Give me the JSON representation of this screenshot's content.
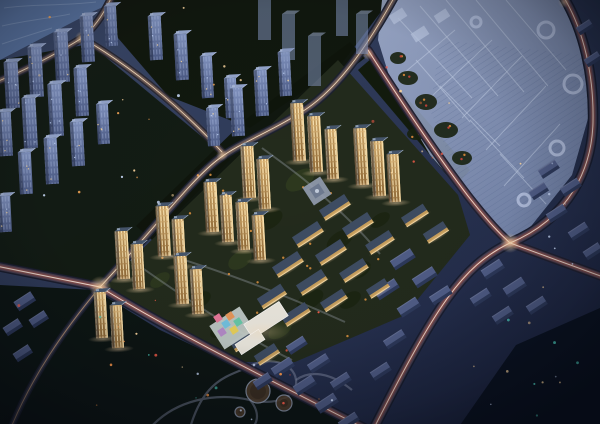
{
  "image": {
    "type": "night-aerial-architectural-rendering",
    "width": 600,
    "height": 424,
    "alt": "Aerial night rendering of a golden-lit residential development amid a dark blue city with glowing road light trails, a ghosted master-plan complex at top right, water at top left and a dark park at bottom left"
  },
  "palette": {
    "bg_top": "#3c4a6a",
    "bg_bottom": "#1b2340",
    "water": "#5d78a6",
    "water_wave": "#8fa6c8",
    "veg_dark": "#101609",
    "veg_park": "#0c1410",
    "veg_corner": "#0a1120",
    "site_ground": "#232b1c",
    "site_shrub": "#d89040",
    "pale_face_hi": "#8395c2",
    "pale_face_lo": "#4c5b86",
    "pale_roof": "#94a5cc",
    "gold_face_hi": "#e3bc7c",
    "gold_face_lo": "#936c38",
    "gold_roof": "#46566c",
    "gold_edge": "#ffe6b0",
    "slab_bg_roof": "#515e88",
    "slab_bg_face": "#2e3a5c",
    "slab_lit_roof": "#3f4d63",
    "slab_lit_face": "#c9a05c",
    "slab_lit_line": "#ffe2a8",
    "road_base": "#151d30",
    "road_major": "#2e3954",
    "road_minor": "#293349",
    "trail_hot_core": "#ffd9bc",
    "trail_hot_mid": "#ff7a52",
    "trail_hot_glow": "#a23c34",
    "trail_warm_core": "#fff0d4",
    "trail_warm_mid": "#ffb26a",
    "trail_warm_glow": "#b06030",
    "ghost_hi": "#b2c0e0",
    "ghost_lo": "#7e90b8",
    "ghost_line": "#ccd7ee",
    "ghost_ring": "#bcc9e6",
    "kindergarten_white": "#ece8de"
  },
  "scene": {
    "water": {
      "poly": "0,0 118,0 92,12 48,35 0,60",
      "waves": [
        "M4,8 C30,4 60,6 96,2",
        "M2,26 C28,20 52,18 70,14",
        "M2,44 C20,38 36,33 52,28"
      ]
    },
    "veg": [
      {
        "poly": "110,0 390,0 340,66 250,128 168,96 118,38",
        "c": "#101609"
      },
      {
        "poly": "0,60 90,44 230,160 100,288 0,270",
        "c": "#121a10"
      },
      {
        "poly": "350,42 365,58 258,140 152,240 136,226 245,120",
        "c": "#0f150c"
      },
      {
        "poly": "0,285 95,290 160,330 240,368 330,410 362,428 0,428",
        "c": "#0c1410"
      },
      {
        "poly": "372,58 470,170 456,186 358,70",
        "c": "#111909"
      },
      {
        "poly": "368,252 416,262 398,312 356,302",
        "c": "#10180d"
      },
      {
        "poly": "516,345 600,308 600,428 458,428",
        "c": "#0a1120"
      }
    ],
    "site": {
      "poly": "338,60 458,195 470,235 405,315 295,362 228,362 100,290 255,140",
      "fill": "#232b1c",
      "mottle": [
        [
          300,
          180,
          16,
          9
        ],
        [
          270,
          220,
          14,
          8
        ],
        [
          340,
          240,
          15,
          8
        ],
        [
          240,
          260,
          13,
          8
        ],
        [
          310,
          300,
          15,
          8
        ],
        [
          200,
          300,
          12,
          7
        ],
        [
          280,
          330,
          13,
          7
        ],
        [
          360,
          270,
          12,
          7
        ],
        [
          380,
          220,
          11,
          6
        ],
        [
          160,
          280,
          11,
          6
        ],
        [
          220,
          330,
          11,
          6
        ],
        [
          350,
          300,
          12,
          7
        ]
      ],
      "paths": [
        "M262,148 C295,172 308,182 317,191 C342,212 362,232 380,254",
        "M158,252 C220,270 285,295 345,322",
        "M120,252 C175,292 235,332 292,360"
      ]
    },
    "ghost": {
      "poly": "382,0 563,0 584,55 589,115 572,175 528,230 506,240 480,212 430,155 395,95 378,40",
      "hatch": "440,40 584,55 589,115 572,175 528,230 506,240 455,170 430,110",
      "lines": [
        "M398,18 L472,98",
        "M420,6 L498,96",
        "M446,0 L524,92",
        "M476,0 L548,86",
        "M506,0 L566,70",
        "M416,60 L470,122",
        "M440,86 L500,146",
        "M470,120 L524,178",
        "M500,154 L546,204",
        "M455,30 L398,78",
        "M492,40 L432,96",
        "M522,56 L462,118",
        "M546,86 L486,150",
        "M560,124 L504,186"
      ],
      "rings": [
        [
          546,
          30,
          8
        ],
        [
          573,
          84,
          9
        ],
        [
          557,
          148,
          7
        ],
        [
          476,
          22,
          5
        ],
        [
          524,
          200,
          6
        ]
      ],
      "veg": [
        [
          408,
          78,
          10,
          7
        ],
        [
          426,
          102,
          11,
          8
        ],
        [
          446,
          130,
          12,
          8
        ],
        [
          416,
          134,
          9,
          6
        ],
        [
          462,
          158,
          10,
          7
        ],
        [
          398,
          58,
          8,
          6
        ]
      ],
      "blocks": [
        [
          398,
          16,
          16,
          10
        ],
        [
          420,
          34,
          16,
          10
        ],
        [
          442,
          16,
          14,
          9
        ]
      ],
      "dotseed": 23
    },
    "park": {
      "paths": [
        "M150,428 C175,400 215,392 250,400 C278,406 298,396 296,380 C294,362 268,356 250,366 C232,376 205,376 190,428",
        "M296,380 C310,370 330,372 352,390",
        "M250,400 C260,412 258,422 252,428"
      ],
      "circles": [
        [
          258,
          391,
          12
        ],
        [
          284,
          403,
          8
        ],
        [
          240,
          412,
          5
        ]
      ]
    },
    "roads": [
      {
        "d": "M112,-4 C104,14 94,28 82,38",
        "w": 5,
        "s": "warm"
      },
      {
        "d": "M82,38 C56,54 26,70 -4,82",
        "w": 5,
        "s": "warm"
      },
      {
        "d": "M82,38 C124,62 176,102 222,152",
        "w": 4.5,
        "s": "warm"
      },
      {
        "d": "M395,-4 C362,56 332,94 300,113 C270,132 240,143 220,158 C192,178 152,232 100,287",
        "w": 6,
        "s": "warm"
      },
      {
        "d": "M-4,266 L100,287 C170,330 262,376 368,430",
        "w": 7,
        "s": "hot"
      },
      {
        "d": "M100,287 C64,330 32,376 10,430",
        "w": 4,
        "s": "dim"
      },
      {
        "d": "M368,50 C400,100 436,154 468,196 C490,224 500,234 510,243 L606,278",
        "w": 6,
        "s": "hot"
      },
      {
        "d": "M563,-4 C584,30 594,76 593,122 C592,168 570,218 510,243 C462,266 436,306 373,430",
        "w": 7.5,
        "s": "hot"
      }
    ],
    "trail_styles": {
      "hot": [
        [
          "#a23c34",
          4.2,
          0.4,
          1
        ],
        [
          "#ff7a52",
          2.0,
          0.8,
          1
        ],
        [
          "#ffd9bc",
          1.0,
          0.95,
          0
        ],
        [
          "#dfe9ff",
          0.5,
          0.7,
          0
        ]
      ],
      "warm": [
        [
          "#b06030",
          3.2,
          0.4,
          1
        ],
        [
          "#ffb26a",
          1.5,
          0.85,
          1
        ],
        [
          "#fff0d4",
          0.8,
          0.9,
          0
        ]
      ],
      "dim": [
        [
          "#7c4c3a",
          2.4,
          0.4,
          1
        ],
        [
          "#e8b88a",
          1.0,
          0.65,
          0
        ]
      ]
    },
    "blooms": [
      [
        100,
        287,
        11,
        0.9
      ],
      [
        510,
        243,
        10,
        0.9
      ],
      [
        82,
        38,
        7,
        0.8
      ],
      [
        222,
        155,
        6,
        0.6
      ],
      [
        368,
        54,
        6,
        0.6
      ],
      [
        564,
        2,
        6,
        0.6
      ]
    ],
    "bg_towers": [
      [
        6,
        62,
        14,
        46
      ],
      [
        30,
        47,
        14,
        50
      ],
      [
        56,
        32,
        14,
        50
      ],
      [
        82,
        16,
        13,
        46
      ],
      [
        106,
        6,
        12,
        40
      ],
      [
        0,
        112,
        13,
        44
      ],
      [
        24,
        98,
        14,
        50
      ],
      [
        50,
        84,
        14,
        52
      ],
      [
        76,
        68,
        13,
        48
      ],
      [
        20,
        152,
        13,
        42
      ],
      [
        46,
        138,
        13,
        46
      ],
      [
        72,
        122,
        13,
        44
      ],
      [
        98,
        104,
        12,
        40
      ],
      [
        0,
        196,
        12,
        36
      ],
      [
        150,
        16,
        13,
        44
      ],
      [
        176,
        34,
        13,
        46
      ],
      [
        202,
        56,
        12,
        42
      ],
      [
        226,
        78,
        12,
        40
      ],
      [
        232,
        88,
        13,
        48
      ],
      [
        256,
        70,
        13,
        46
      ],
      [
        280,
        52,
        12,
        44
      ],
      [
        208,
        108,
        12,
        38
      ]
    ],
    "ghost_towers": [
      [
        258,
        0,
        13,
        40
      ],
      [
        282,
        14,
        13,
        46
      ],
      [
        308,
        36,
        13,
        50
      ],
      [
        336,
        0,
        12,
        36
      ],
      [
        356,
        14,
        12,
        40
      ]
    ],
    "bg_slabs": [
      [
        402,
        258,
        24,
        8
      ],
      [
        424,
        276,
        24,
        8
      ],
      [
        440,
        294,
        22,
        7
      ],
      [
        386,
        288,
        24,
        8
      ],
      [
        408,
        306,
        22,
        8
      ],
      [
        394,
        338,
        22,
        7
      ],
      [
        380,
        370,
        20,
        7
      ],
      [
        282,
        366,
        22,
        8
      ],
      [
        304,
        384,
        22,
        8
      ],
      [
        326,
        402,
        22,
        8
      ],
      [
        348,
        420,
        20,
        7
      ],
      [
        296,
        344,
        20,
        7
      ],
      [
        318,
        362,
        22,
        7
      ],
      [
        340,
        380,
        20,
        7
      ],
      [
        262,
        380,
        18,
        7
      ],
      [
        492,
        268,
        22,
        8
      ],
      [
        514,
        286,
        22,
        8
      ],
      [
        536,
        304,
        20,
        7
      ],
      [
        480,
        296,
        20,
        7
      ],
      [
        502,
        314,
        20,
        7
      ],
      [
        548,
        168,
        20,
        7
      ],
      [
        570,
        186,
        20,
        7
      ],
      [
        556,
        212,
        20,
        7
      ],
      [
        578,
        230,
        20,
        7
      ],
      [
        592,
        250,
        18,
        7
      ],
      [
        538,
        190,
        18,
        7
      ],
      [
        24,
        300,
        20,
        8
      ],
      [
        12,
        326,
        18,
        7
      ],
      [
        38,
        318,
        18,
        7
      ],
      [
        22,
        352,
        18,
        7
      ],
      [
        584,
        26,
        16,
        6
      ],
      [
        592,
        58,
        16,
        6
      ]
    ],
    "lit_slabs": [
      [
        334,
        206,
        30,
        9
      ],
      [
        357,
        224,
        30,
        9
      ],
      [
        379,
        241,
        28,
        8
      ],
      [
        307,
        233,
        30,
        9
      ],
      [
        330,
        251,
        30,
        9
      ],
      [
        353,
        269,
        28,
        8
      ],
      [
        287,
        263,
        30,
        9
      ],
      [
        311,
        281,
        30,
        9
      ],
      [
        333,
        299,
        26,
        8
      ],
      [
        271,
        295,
        28,
        9
      ],
      [
        295,
        313,
        28,
        8
      ],
      [
        414,
        214,
        26,
        8
      ],
      [
        435,
        231,
        24,
        8
      ],
      [
        243,
        339,
        26,
        8
      ],
      [
        266,
        353,
        24,
        8
      ],
      [
        377,
        287,
        22,
        7
      ]
    ],
    "lit_towers": [
      [
        293,
        103,
        13,
        58
      ],
      [
        310,
        116,
        13,
        56
      ],
      [
        327,
        129,
        12,
        50
      ],
      [
        356,
        128,
        13,
        57
      ],
      [
        373,
        141,
        13,
        55
      ],
      [
        389,
        154,
        12,
        48
      ],
      [
        243,
        146,
        13,
        52
      ],
      [
        259,
        159,
        12,
        50
      ],
      [
        206,
        182,
        13,
        50
      ],
      [
        222,
        195,
        12,
        47
      ],
      [
        158,
        206,
        13,
        50
      ],
      [
        174,
        219,
        12,
        47
      ],
      [
        117,
        231,
        13,
        48
      ],
      [
        133,
        244,
        12,
        45
      ],
      [
        238,
        202,
        12,
        48
      ],
      [
        254,
        215,
        12,
        45
      ],
      [
        176,
        256,
        13,
        48
      ],
      [
        192,
        269,
        12,
        45
      ],
      [
        96,
        292,
        12,
        46
      ],
      [
        112,
        305,
        12,
        43
      ]
    ],
    "kindergarten": {
      "pad": [
        232,
        328,
        36,
        28
      ],
      "blocks": [
        [
          266,
          320,
          42,
          17
        ],
        [
          250,
          342,
          28,
          12
        ]
      ],
      "tiles": [
        [
          218,
          318,
          "#e8799a"
        ],
        [
          226,
          324,
          "#74c2e0"
        ],
        [
          234,
          330,
          "#e8d05a"
        ],
        [
          222,
          332,
          "#b48ac8"
        ],
        [
          230,
          316,
          "#e8975a"
        ],
        [
          238,
          322,
          "#68c8a8"
        ]
      ]
    },
    "plaza": {
      "cx": 317,
      "cy": 191,
      "s": 21
    },
    "shrubs": {
      "n": 18,
      "seed": 11,
      "x0": 140,
      "x1": 420,
      "y0": 165,
      "y1": 340
    },
    "speckles": [
      {
        "x0": 15,
        "x1": 345,
        "y0": 298,
        "y1": 420,
        "n": 26,
        "seed": 7,
        "colors": [
          "#ff9a4a",
          "#ffd9a0",
          "#52e0cc",
          "#ff5f4a",
          "#cfe0ff"
        ]
      },
      {
        "x0": 0,
        "x1": 255,
        "y0": 0,
        "y1": 205,
        "n": 20,
        "seed": 3,
        "colors": [
          "#ffd9a0",
          "#ffad5a",
          "#cfe0ff"
        ]
      },
      {
        "x0": 465,
        "x1": 595,
        "y0": 315,
        "y1": 420,
        "n": 12,
        "seed": 9,
        "colors": [
          "#52e0cc",
          "#ff5f4a",
          "#ffd9a0",
          "#cfe0ff"
        ]
      },
      {
        "x0": 360,
        "x1": 465,
        "y0": 65,
        "y1": 185,
        "n": 10,
        "seed": 5,
        "colors": [
          "#ff5f4a",
          "#e86a3a",
          "#ffd9a0"
        ]
      },
      {
        "x0": 520,
        "x1": 600,
        "y0": 150,
        "y1": 300,
        "n": 8,
        "seed": 13,
        "colors": [
          "#cfe0ff",
          "#ffd9a0"
        ]
      }
    ]
  }
}
